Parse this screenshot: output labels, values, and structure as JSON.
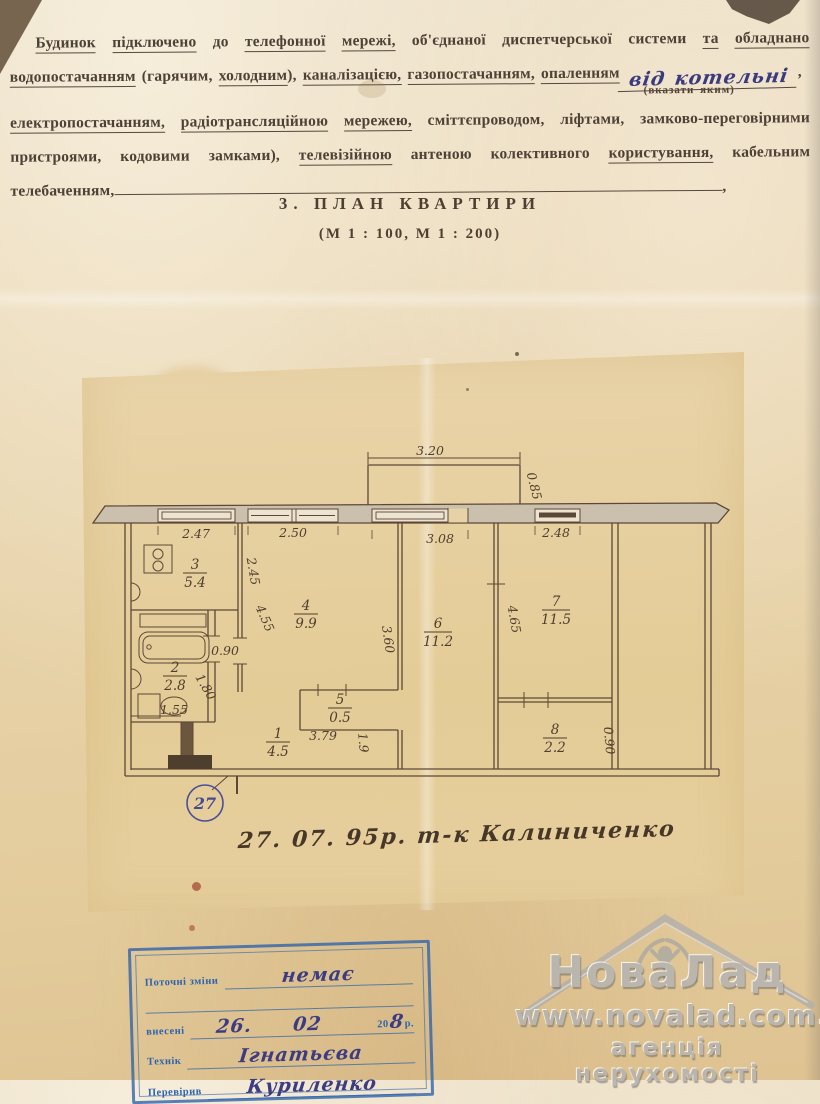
{
  "intro": {
    "lines": [
      {
        "cls": "just ind",
        "segments": [
          {
            "t": "Будинок",
            "u": true
          },
          {
            "t": " "
          },
          {
            "t": "підключено",
            "u": true
          },
          {
            "t": " до "
          },
          {
            "t": "телефонної",
            "u": true
          },
          {
            "t": " "
          },
          {
            "t": "мережі,",
            "u": true
          },
          {
            "t": " об'єднаної диспетчерської системи "
          },
          {
            "t": "та",
            "u": true
          },
          {
            "t": " "
          },
          {
            "t": "обладнано",
            "u": true
          }
        ]
      },
      {
        "cls": "",
        "segments": [
          {
            "t": "водопостачанням",
            "u": true
          },
          {
            "t": " (гарячим, "
          },
          {
            "t": "холодним",
            "u": true
          },
          {
            "t": "), "
          },
          {
            "t": "каналізацією,",
            "u": true
          },
          {
            "t": " "
          },
          {
            "t": "газопостачанням,",
            "u": true
          },
          {
            "t": " "
          },
          {
            "t": "опаленням",
            "u": true
          },
          {
            "t": "від котельні",
            "hw": true
          },
          {
            "t": ","
          }
        ]
      },
      {
        "cls": "note",
        "segments": [
          {
            "t": "(вказати яким)"
          }
        ]
      },
      {
        "cls": "just",
        "segments": [
          {
            "t": "електропостачанням,",
            "u": true
          },
          {
            "t": " "
          },
          {
            "t": "радіотрансляційною",
            "u": true
          },
          {
            "t": " "
          },
          {
            "t": "мережею,",
            "u": true
          },
          {
            "t": " сміттєпроводом, ліфтами, замково-переговірними"
          }
        ]
      },
      {
        "cls": "just",
        "segments": [
          {
            "t": "пристроями, кодовими замками), "
          },
          {
            "t": "телевізійною",
            "u": true
          },
          {
            "t": " антеною колективного "
          },
          {
            "t": "користування,",
            "u": true
          },
          {
            "t": " кабельним"
          }
        ]
      },
      {
        "cls": "",
        "segments": [
          {
            "t": "телебаченням,"
          },
          {
            "rule": true
          },
          {
            "t": ","
          }
        ]
      }
    ]
  },
  "title": {
    "section": "3. ПЛАН КВАРТИРИ",
    "scale": "(М 1 : 100, М 1 : 200)"
  },
  "plan": {
    "apartment_number": "27",
    "date_note": "27. 07. 95р.   т-к  Калиниченко",
    "rooms": [
      {
        "num": "1",
        "area": "4.5"
      },
      {
        "num": "2",
        "area": "2.8"
      },
      {
        "num": "3",
        "area": "5.4"
      },
      {
        "num": "4",
        "area": "9.9"
      },
      {
        "num": "5",
        "area": "0.5"
      },
      {
        "num": "6",
        "area": "11.2"
      },
      {
        "num": "7",
        "area": "11.5"
      },
      {
        "num": "8",
        "area": "2.2"
      }
    ],
    "dims": {
      "balcony_w": "3.20",
      "balcony_d": "0.85",
      "win1": "2.47",
      "win2": "2.50",
      "win3": "3.08",
      "win4": "2.48",
      "kitchen": "2.45",
      "room4_diag": "4.55",
      "room4_depth": "3.60",
      "room7_depth": "4.65",
      "bath_door": "0.90",
      "bath_diag": "1.80",
      "bath_w": "1.55",
      "closet_w": "3.79",
      "hall": "1.9",
      "room8_h": "0.90"
    }
  },
  "stamp": {
    "current_changes_label": "Поточні зміни",
    "current_changes_value": "немає",
    "entered_label": "внесені",
    "entered_day": "26.",
    "entered_month": "02",
    "year_prefix": "20",
    "year_hand": "8",
    "year_suffix": "р.",
    "technician_label": "Технік",
    "technician_value": "Ігнатьєва",
    "verified_label": "Перевірив",
    "verified_value": "Куриленко"
  },
  "watermark": {
    "brand": "НоваЛад",
    "url": "www.novalad.com.ua",
    "tagline": "агенція нерухомості"
  }
}
